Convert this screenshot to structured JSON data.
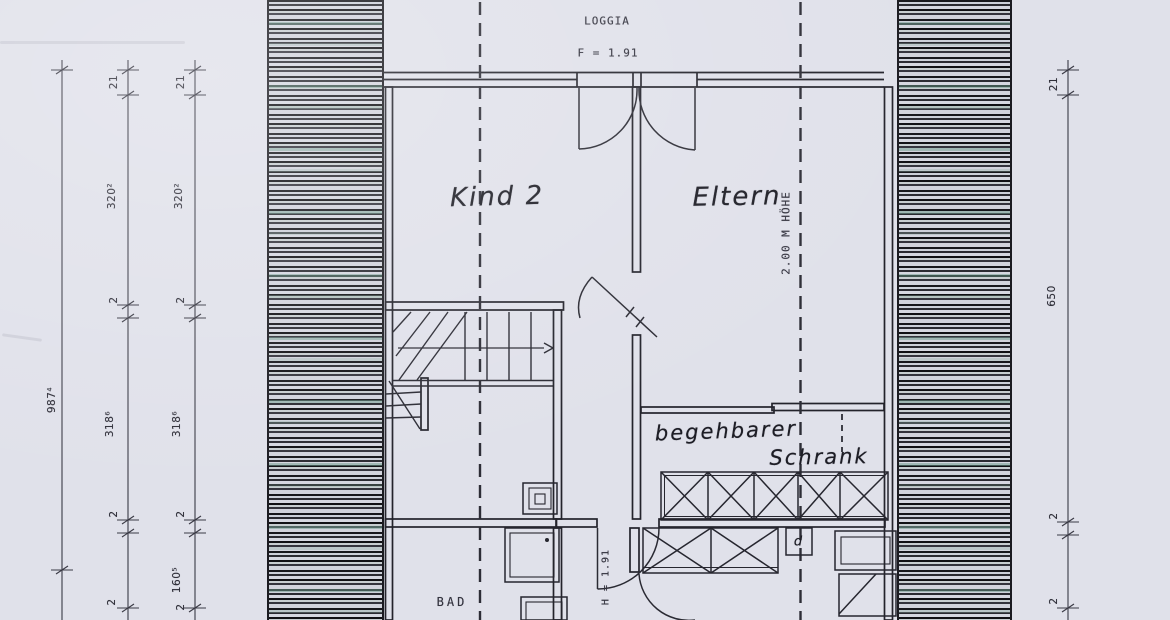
{
  "drawing": {
    "rooms": {
      "kind2": "Kind 2",
      "eltern": "Eltern",
      "schrank_line1": "begehbarer",
      "schrank_line2": "Schrank",
      "bad": "BAD",
      "loggia": "LOGGIA"
    },
    "annotations": {
      "loggia_height": "F = 1.91",
      "knee_wall_height": "2.00 M HÖHE",
      "door_height": "H = 1.91",
      "closet_symbol": "d"
    },
    "dimensions": {
      "left_outer": {
        "total": "987⁴"
      },
      "left_middle": [
        "21",
        "320²",
        "2",
        "318⁶",
        "2",
        "2"
      ],
      "left_inner": [
        "21",
        "320²",
        "2",
        "318⁶",
        "2",
        "160⁵",
        "2"
      ],
      "right": [
        "21",
        "650",
        "2",
        "2"
      ]
    },
    "colors": {
      "paper": "#e0e1ea",
      "ink": "#23232b",
      "hatch_dark": "#16161b",
      "hatch_teal": "#9db5ab"
    }
  }
}
